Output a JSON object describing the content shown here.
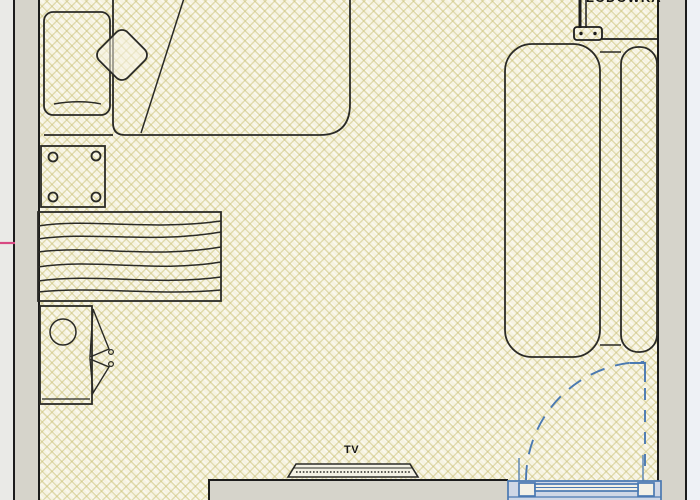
{
  "drawing": {
    "kind": "room floor plan (scanned)",
    "labels": {
      "fridge": "LODÓWKA",
      "tv": "TV"
    },
    "items": [
      "bed",
      "pillow",
      "armchair",
      "side-table",
      "rug-chest",
      "cabinet-with-doors",
      "sofa",
      "tv-set",
      "fridge-door-hinge",
      "entry-door-with-swing-arc"
    ],
    "colors": {
      "floor_base": "#f6f3e1",
      "hatch_line": "#cac178",
      "wall_fill": "#d6d4cb",
      "wall_line": "#1c1c1c",
      "furniture_line": "#2a2a26",
      "door_blue": "#4a79b2",
      "below_door_fill": "#cfd7e6",
      "outside_right": "#eef1f5",
      "registration_mark_pink": "#d84982"
    }
  }
}
